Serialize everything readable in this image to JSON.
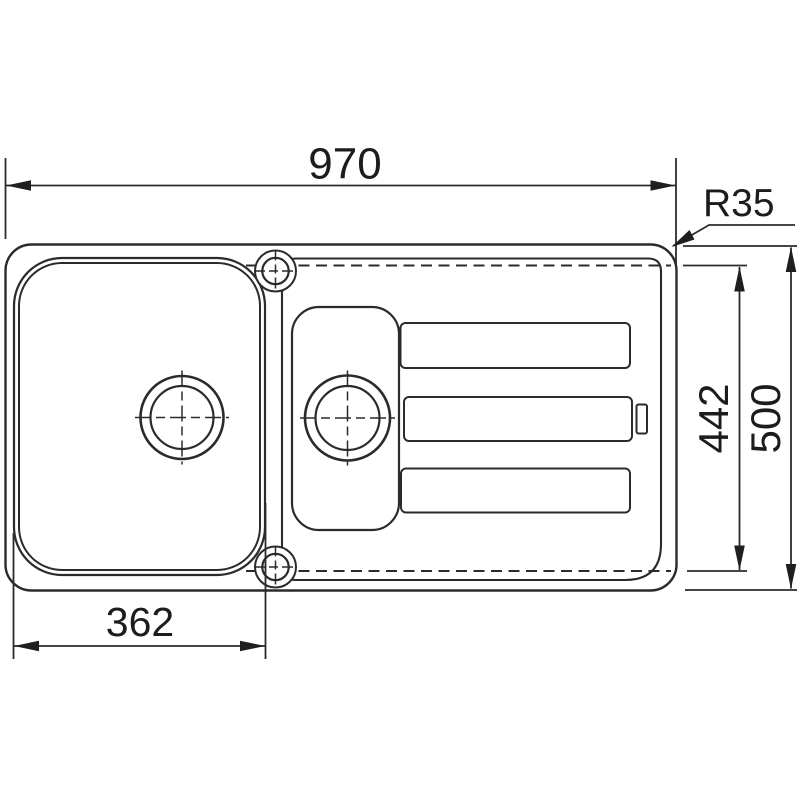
{
  "drawing": {
    "subject": "Inset kitchen sink with one and a half bowls and drainer - plan view technical drawing",
    "background_color": "#ffffff",
    "line_color": "#2b2b2b",
    "text_color": "#1c1c1c",
    "dimensions": {
      "overall_width": "970",
      "corner_radius": "R35",
      "inner_depth": "442",
      "overall_depth": "500",
      "main_bowl_width": "362"
    }
  }
}
